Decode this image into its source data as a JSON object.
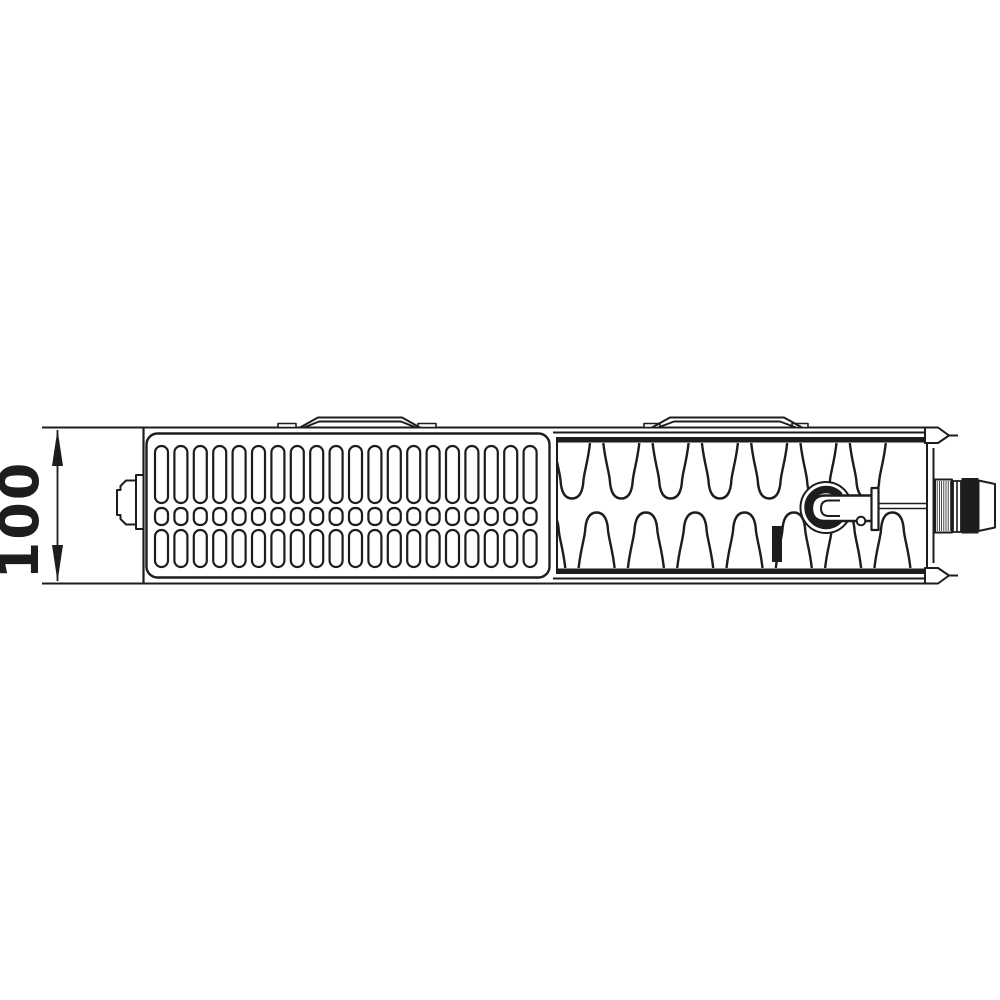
{
  "colors": {
    "background": "#ffffff",
    "line": "#1d1d1b"
  },
  "dimension": {
    "value": "100"
  },
  "parts": {
    "drawing": "radiator-top-view",
    "left_section": "slotted-top-grille",
    "right_section": "convector-fin-section",
    "valve": "integrated-valve",
    "connection": "valve-tail-connection"
  }
}
